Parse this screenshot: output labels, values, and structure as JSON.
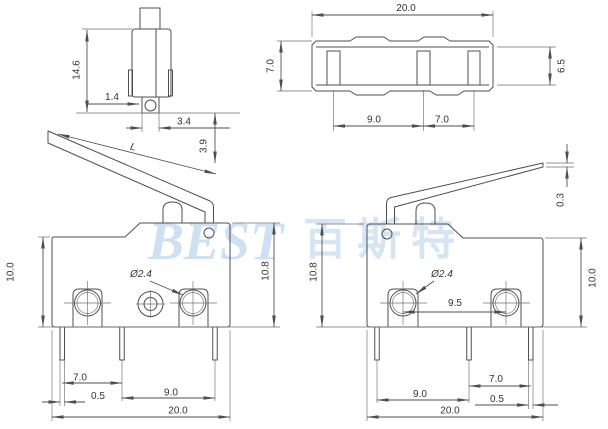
{
  "watermark": {
    "brand": "BEST",
    "brand_cn": "百斯特"
  },
  "views": {
    "side": {
      "dims": {
        "height": "14.6",
        "roller_offset": "1.4",
        "roller_width": "3.4",
        "lever_travel": "3.9"
      }
    },
    "top": {
      "dims": {
        "width": "20.0",
        "height": "7.0",
        "inner_height": "6.5",
        "terminal_pitch_left": "9.0",
        "terminal_pitch_right": "7.0"
      }
    },
    "front_left": {
      "dims": {
        "body_height": "10.0",
        "total_height": "10.8",
        "hole_diameter": "Ø2.4",
        "lever_length": "L",
        "pin_pitch_left": "7.0",
        "pin_thickness": "0.5",
        "pin_pitch_right": "9.0",
        "width": "20.0"
      }
    },
    "front_right": {
      "dims": {
        "lever_tip_thickness": "0.3",
        "total_height": "10.8",
        "body_height": "10.0",
        "hole_diameter": "Ø2.4",
        "hole_pitch": "9.5",
        "pin_pitch_left": "9.0",
        "pin_pitch_right": "7.0",
        "pin_thickness": "0.5",
        "width": "20.0"
      }
    }
  },
  "colors": {
    "line": "#4f4f4f",
    "text": "#333333",
    "watermark": "#c9ddf1",
    "background": "#ffffff"
  }
}
